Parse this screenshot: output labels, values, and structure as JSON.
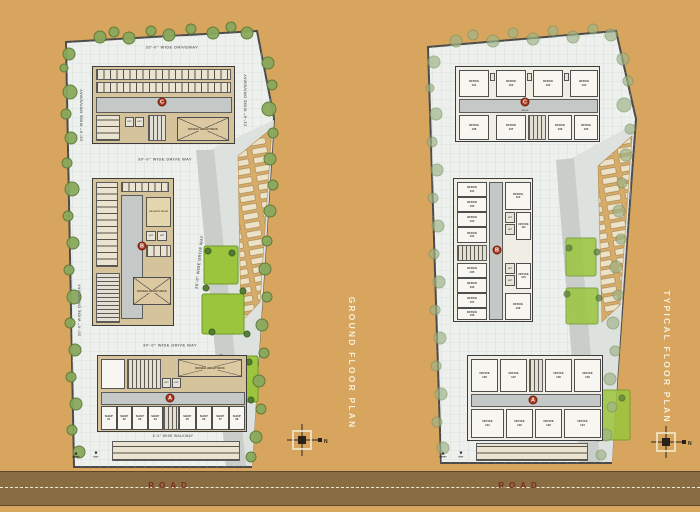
{
  "scene": {
    "road_label": "ROAD",
    "compass_n": "N"
  },
  "left_plan": {
    "title": "GROUND FLOOR PLAN",
    "driveway_top": "20'-0\" WIDE DRIVEWAY",
    "driveway_left_upper": "23'-0\" WIDE DRIVEWAY",
    "driveway_left_lower": "20'-0\" WIDE DRIVEWAY",
    "driveway_right": "21'-6\" WIDE DRIVEWAY",
    "drive_mid_upper": "30'-0\" WIDE DRIVE WAY",
    "drive_mid_lower": "30'-0\" WIDE DRIVE WAY",
    "drive_internal": "20'-0\" WIDE DRIVE WAY",
    "walkway": "8'-0\" WIDE WALKWAY",
    "deck_label": "DOUBLE HEIGHT DECK",
    "security_label": "SECURITY ROOM",
    "lift_label": "LIFT",
    "stair_label": "UP",
    "entry_label": "ENTRY",
    "exit_label": "EXIT",
    "badges": {
      "top": "C",
      "mid": "B",
      "bottom": "A"
    },
    "shops": [
      {
        "name": "SHOP",
        "num": "01"
      },
      {
        "name": "SHOP",
        "num": "02"
      },
      {
        "name": "SHOP",
        "num": "03"
      },
      {
        "name": "SHOP",
        "num": "04"
      },
      {
        "name": "SHOP",
        "num": "05"
      },
      {
        "name": "SHOP",
        "num": "06"
      },
      {
        "name": "SHOP",
        "num": "07"
      },
      {
        "name": "SHOP",
        "num": "08"
      }
    ]
  },
  "right_plan": {
    "title": "TYPICAL FLOOR PLAN",
    "lift_label": "LIFT",
    "stair_label": "DN UP",
    "entry_label": "ENTRY",
    "exit_label": "EXIT",
    "badges": {
      "top": "C",
      "mid": "B",
      "bottom": "A"
    },
    "c_top": [
      {
        "name": "OFFICE",
        "num": "101"
      },
      {
        "name": "OFFICE",
        "num": "102"
      },
      {
        "name": "OFFICE",
        "num": "103"
      },
      {
        "name": "OFFICE",
        "num": "104"
      }
    ],
    "c_bottom": [
      {
        "name": "OFFICE",
        "num": "108"
      },
      {
        "name": "OFFICE",
        "num": "107"
      },
      {
        "name": "OFFICE",
        "num": "106"
      },
      {
        "name": "OFFICE",
        "num": "105"
      }
    ],
    "b_left_top": [
      {
        "name": "OFFICE",
        "num": "101"
      },
      {
        "name": "OFFICE",
        "num": "102"
      },
      {
        "name": "OFFICE",
        "num": "103"
      },
      {
        "name": "OFFICE",
        "num": "104"
      }
    ],
    "b_left_bottom": [
      {
        "name": "OFFICE",
        "num": "105"
      },
      {
        "name": "OFFICE",
        "num": "106"
      },
      {
        "name": "OFFICE",
        "num": "107"
      },
      {
        "name": "OFFICE",
        "num": "108"
      }
    ],
    "b_right": [
      {
        "name": "OFFICE",
        "num": "112"
      },
      {
        "name": "OFFICE",
        "num": "111"
      },
      {
        "name": "OFFICE",
        "num": "110"
      },
      {
        "name": "OFFICE",
        "num": "109"
      }
    ],
    "a_top": [
      {
        "name": "OFFICE",
        "num": "108"
      },
      {
        "name": "OFFICE",
        "num": "107"
      },
      {
        "name": "OFFICE",
        "num": "106"
      },
      {
        "name": "OFFICE",
        "num": "105"
      }
    ],
    "a_bottom": [
      {
        "name": "OFFICE",
        "num": "101"
      },
      {
        "name": "OFFICE",
        "num": "102"
      },
      {
        "name": "OFFICE",
        "num": "103"
      },
      {
        "name": "OFFICE",
        "num": "104"
      }
    ]
  }
}
